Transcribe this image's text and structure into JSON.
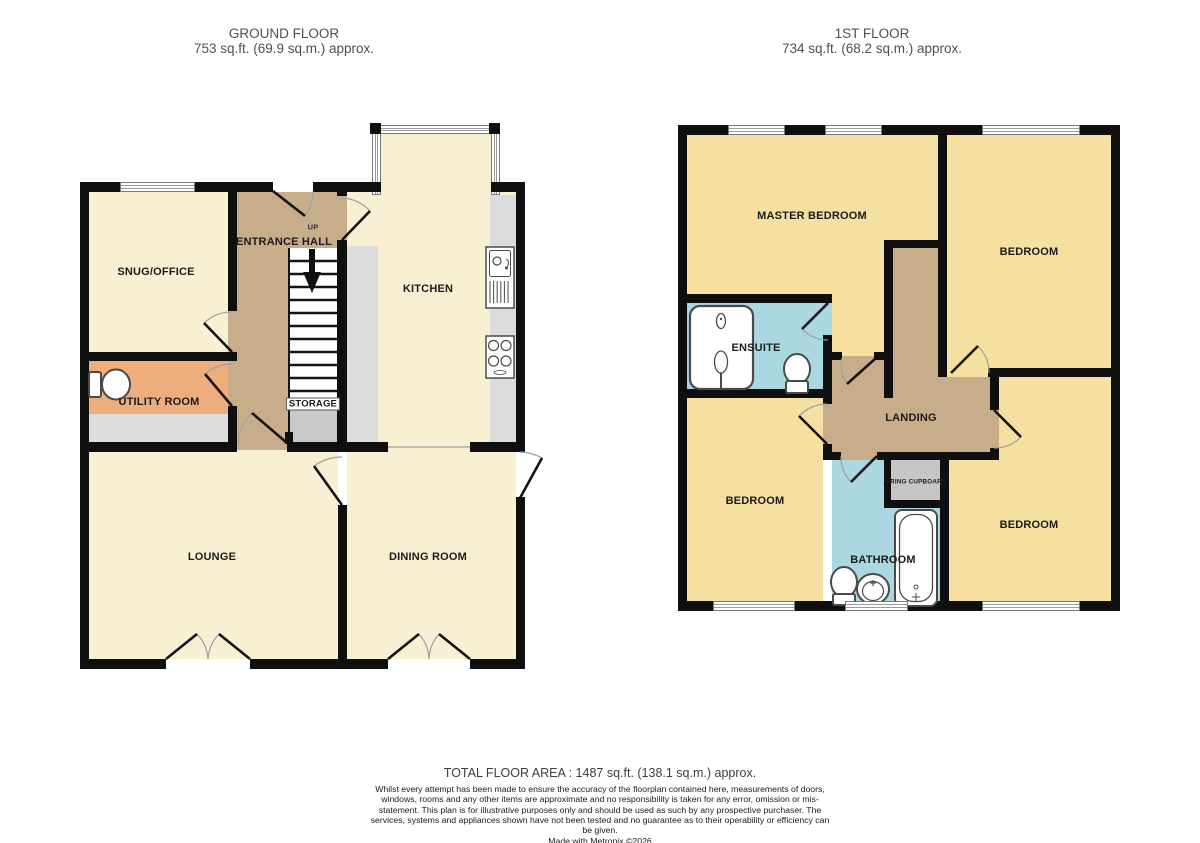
{
  "header": {
    "ground": {
      "title": "GROUND FLOOR",
      "area": "753 sq.ft. (69.9 sq.m.) approx."
    },
    "first": {
      "title": "1ST FLOOR",
      "area": "734 sq.ft. (68.2 sq.m.) approx."
    }
  },
  "ground": {
    "rooms": {
      "snug": "SNUG/OFFICE",
      "hall": "ENTRANCE HALL",
      "up": "UP",
      "kitchen": "KITCHEN",
      "utility": "UTILITY ROOM",
      "storage": "STORAGE",
      "lounge": "LOUNGE",
      "dining": "DINING ROOM"
    }
  },
  "first": {
    "rooms": {
      "master": "MASTER BEDROOM",
      "bedroom_tr": "BEDROOM",
      "ensuite": "ENSUITE",
      "landing": "LANDING",
      "bedroom_bl": "BEDROOM",
      "airing": "AIRING CUPBOARD",
      "bathroom": "BATHROOM",
      "bedroom_br": "BEDROOM"
    }
  },
  "footer": {
    "total": "TOTAL FLOOR AREA : 1487 sq.ft. (138.1 sq.m.) approx.",
    "disclaimer": "Whilst every attempt has been made to ensure the accuracy of the floorplan contained here, measurements of doors, windows, rooms and any other items are approximate and no responsibility is taken for any error, omission or mis-statement. This plan is for illustrative purposes only and should be used as such by any prospective purchaser. The services, systems and appliances shown have not been tested and no guarantee as to their operability or efficiency can be given.",
    "credit": "Made with Metropix ©2026"
  },
  "colors": {
    "wall": "#0f0f0f",
    "ground_room": "#f7f0d3",
    "first_room": "#f5dfa1",
    "hall_landing": "#c8ad8a",
    "utility": "#eead7c",
    "wet_room": "#abd7e2",
    "counter": "#dcdcdc",
    "storage": "#c9c9c9"
  }
}
